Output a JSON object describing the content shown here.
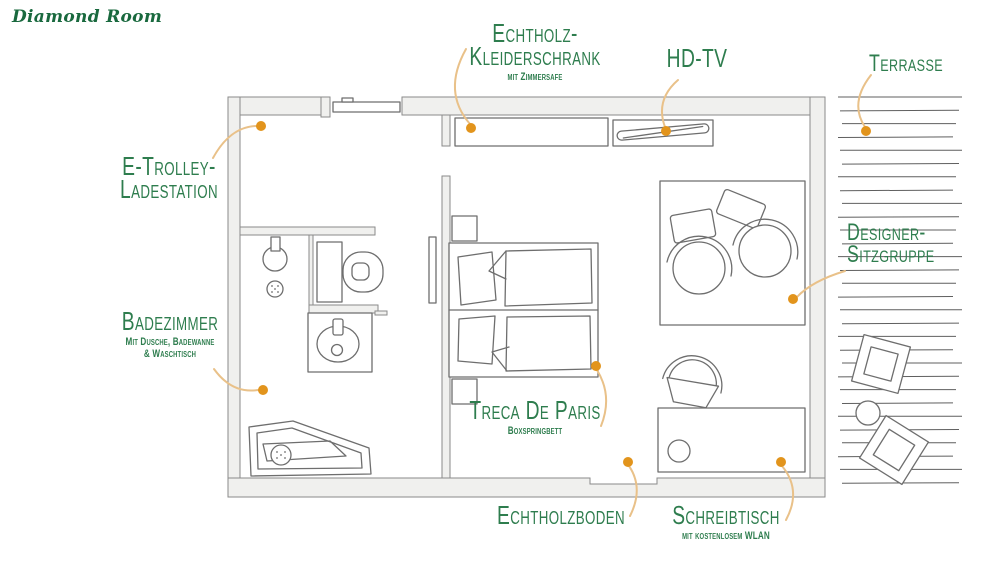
{
  "title": "Diamond Room",
  "colors": {
    "label_green": "#2e7d4e",
    "title_green": "#19693e",
    "marker_orange": "#e2941c",
    "leader_tan": "#e9c189",
    "wall_fill": "#f0f0ee",
    "wall_stroke": "#8a8a8a",
    "furniture_stroke": "#6e6e6e",
    "deck_line": "#5f5f5f"
  },
  "labels": {
    "wardrobe": {
      "line1": "Echtholz-",
      "line2": "Kleiderschrank",
      "sub": "mit Zimmersafe"
    },
    "tv": {
      "line1": "HD-TV"
    },
    "terrace": {
      "line1": "Terrasse"
    },
    "trolley": {
      "line1": "E-Trolley-",
      "line2": "Ladestation"
    },
    "seating": {
      "line1": "Designer-",
      "line2": "Sitzgruppe"
    },
    "bathroom": {
      "line1": "Badezimmer",
      "sub1": "Mit Dusche, Badewanne",
      "sub2": "& Waschtisch"
    },
    "bed": {
      "line1": "Treca De Paris",
      "sub": "Boxspringbett"
    },
    "floor": {
      "line1": "Echtholzboden"
    },
    "desk": {
      "line1": "Schreibtisch",
      "sub": "mit kostenlosem WLAN"
    }
  }
}
